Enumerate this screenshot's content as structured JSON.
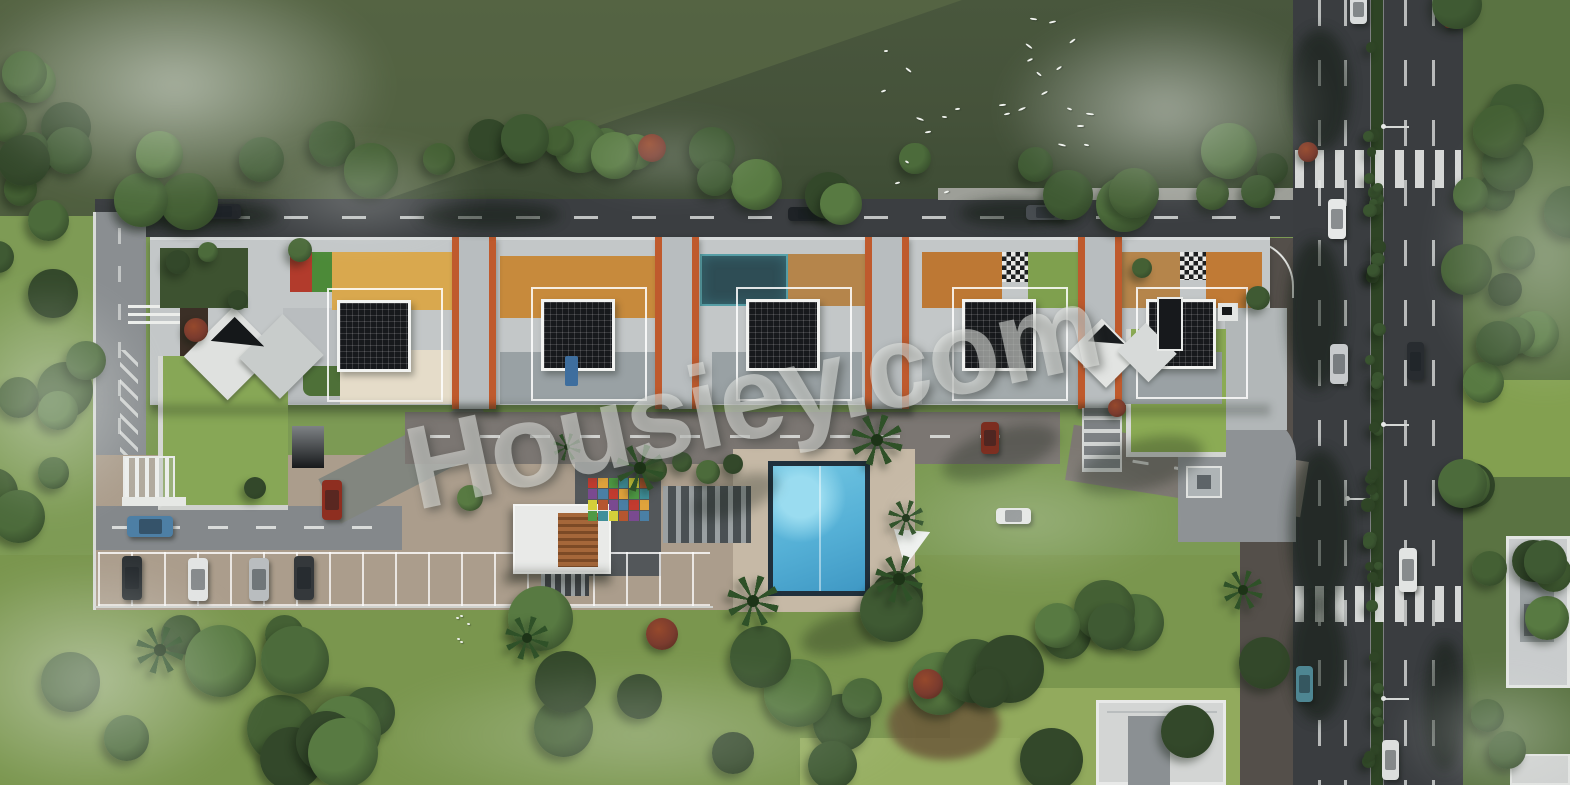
{
  "watermark": {
    "text": "Housiey.com",
    "color": "rgba(230,231,228,0.55)",
    "rotation_deg": -12
  },
  "palette": {
    "field_green": "#45523a",
    "lawn_green": "#87a756",
    "tree_green": "#3f5a33",
    "asphalt": "#3b3e41",
    "internal_road": "#7b7672",
    "paving_tan": "#ab9d8c",
    "slab_gray": "#c3c7c8",
    "accent_terracotta": "#bf5a2d",
    "solar_black": "#17191c",
    "pool_blue": "#55b0d6",
    "deck_orange": "#d9a84e",
    "wood_deck": "#b5854b",
    "court_teal": "#2e4d55",
    "median_green": "#2e4425",
    "fog_white": "#ecf0eb"
  },
  "scene": {
    "solar_panels": [
      {
        "x": 337,
        "y": 300,
        "w": 74,
        "h": 72
      },
      {
        "x": 541,
        "y": 299,
        "w": 74,
        "h": 72
      },
      {
        "x": 746,
        "y": 299,
        "w": 74,
        "h": 72
      },
      {
        "x": 962,
        "y": 299,
        "w": 74,
        "h": 72
      },
      {
        "x": 1146,
        "y": 299,
        "w": 70,
        "h": 70
      }
    ],
    "tower_cores": {
      "xs": [
        452,
        655,
        865,
        1078
      ],
      "y": 237,
      "w": 44,
      "h": 172
    },
    "amenity_segments": [
      {
        "x": 160,
        "y": 248,
        "w": 88,
        "h": 60,
        "color": "#3d5230",
        "pattern": "vstripes"
      },
      {
        "x": 290,
        "y": 252,
        "w": 22,
        "h": 40,
        "color": "#b23b2c"
      },
      {
        "x": 312,
        "y": 252,
        "w": 20,
        "h": 40,
        "color": "#4c8a38"
      },
      {
        "x": 332,
        "y": 252,
        "w": 120,
        "h": 58,
        "color": "#d9a84e",
        "pattern": "hstripes"
      },
      {
        "x": 500,
        "y": 256,
        "w": 155,
        "h": 62,
        "color": "#c78a3c",
        "pattern": "hstripes"
      },
      {
        "x": 700,
        "y": 254,
        "w": 88,
        "h": 52,
        "color": "#2e4d55",
        "pattern": "court"
      },
      {
        "x": 788,
        "y": 254,
        "w": 77,
        "h": 52,
        "color": "#b5854b",
        "pattern": "hstripes"
      },
      {
        "x": 922,
        "y": 252,
        "w": 80,
        "h": 56,
        "color": "#bd7834",
        "pattern": "dots"
      },
      {
        "x": 1002,
        "y": 252,
        "w": 26,
        "h": 30,
        "pattern": "checker"
      },
      {
        "x": 1028,
        "y": 252,
        "w": 52,
        "h": 56,
        "color": "#7fa04e"
      },
      {
        "x": 1122,
        "y": 252,
        "w": 58,
        "h": 56,
        "color": "#b5854b",
        "pattern": "hstripes"
      },
      {
        "x": 1180,
        "y": 252,
        "w": 26,
        "h": 28,
        "pattern": "checker"
      },
      {
        "x": 1206,
        "y": 252,
        "w": 56,
        "h": 56,
        "color": "#c07a35",
        "pattern": "dots"
      }
    ],
    "terraces": [
      {
        "x": 340,
        "y": 350,
        "w": 112,
        "h": 54,
        "color": "#e5dcc9",
        "pattern": "dots-orange"
      },
      {
        "x": 500,
        "y": 352,
        "w": 155,
        "h": 52,
        "color": "#99a1a4",
        "pattern": "dots"
      },
      {
        "x": 712,
        "y": 352,
        "w": 150,
        "h": 52,
        "color": "#99a1a4",
        "pattern": "dots"
      },
      {
        "x": 922,
        "y": 352,
        "w": 156,
        "h": 52,
        "color": "#a3aaac",
        "pattern": "dots"
      },
      {
        "x": 1122,
        "y": 352,
        "w": 100,
        "h": 52,
        "color": "#9aa1a4"
      }
    ],
    "mats": [
      {
        "x": 565,
        "y": 356,
        "w": 13,
        "h": 30,
        "color": "#3e6e9e"
      },
      {
        "x": 837,
        "y": 506,
        "w": 11,
        "h": 22,
        "color": "#27415f"
      },
      {
        "x": 837,
        "y": 540,
        "w": 11,
        "h": 22,
        "color": "#27415f"
      }
    ],
    "playground": {
      "x": 588,
      "y": 478,
      "w": 62,
      "h": 44,
      "cols": 6,
      "rows": 4,
      "colors": [
        "#c23b2f",
        "#e0a33c",
        "#4f9a44",
        "#3f8f9a",
        "#d4cf3a",
        "#b5562f",
        "#7a4a90",
        "#4a7fa5"
      ]
    },
    "cars": [
      {
        "x": 203,
        "y": 204,
        "w": 38,
        "h": 15,
        "color": "#22262a",
        "dir": "h",
        "label": "car-dark"
      },
      {
        "x": 788,
        "y": 207,
        "w": 38,
        "h": 14,
        "color": "#1e2226",
        "dir": "h",
        "label": "car-dark"
      },
      {
        "x": 1026,
        "y": 205,
        "w": 38,
        "h": 15,
        "color": "#474c50",
        "dir": "h",
        "label": "car-gray"
      },
      {
        "x": 1350,
        "y": -6,
        "w": 17,
        "h": 30,
        "color": "#d9dcdc",
        "dir": "v",
        "label": "car-white"
      },
      {
        "x": 1444,
        "y": -4,
        "w": 16,
        "h": 32,
        "color": "#8e3124",
        "dir": "v",
        "label": "truck-red"
      },
      {
        "x": 1328,
        "y": 199,
        "w": 18,
        "h": 40,
        "color": "#e6e8e7",
        "dir": "v",
        "label": "car-white"
      },
      {
        "x": 1330,
        "y": 344,
        "w": 18,
        "h": 40,
        "color": "#c7cacc",
        "dir": "v",
        "label": "car-silver"
      },
      {
        "x": 1407,
        "y": 342,
        "w": 17,
        "h": 38,
        "color": "#282c30",
        "dir": "v",
        "label": "car-dark"
      },
      {
        "x": 1399,
        "y": 548,
        "w": 18,
        "h": 44,
        "color": "#e2e4e3",
        "dir": "v",
        "label": "van-white"
      },
      {
        "x": 1296,
        "y": 666,
        "w": 17,
        "h": 36,
        "color": "#4e8692",
        "dir": "v",
        "label": "car-teal"
      },
      {
        "x": 1382,
        "y": 740,
        "w": 17,
        "h": 40,
        "color": "#dcdedd",
        "dir": "v",
        "label": "car-white"
      },
      {
        "x": 127,
        "y": 516,
        "w": 46,
        "h": 21,
        "color": "#4d7fa5",
        "dir": "h",
        "label": "car-blue"
      },
      {
        "x": 322,
        "y": 480,
        "w": 20,
        "h": 40,
        "color": "#8e2e20",
        "dir": "v",
        "label": "car-red"
      },
      {
        "x": 981,
        "y": 422,
        "w": 18,
        "h": 32,
        "color": "#7c2d1f",
        "dir": "v",
        "label": "car-maroon"
      },
      {
        "x": 996,
        "y": 508,
        "w": 35,
        "h": 16,
        "color": "#e4e6e5",
        "dir": "h",
        "label": "car-white"
      },
      {
        "x": 122,
        "y": 556,
        "w": 20,
        "h": 44,
        "color": "#2c3134",
        "dir": "v",
        "label": "car-dark"
      },
      {
        "x": 188,
        "y": 558,
        "w": 20,
        "h": 43,
        "color": "#e2e4e3",
        "dir": "v",
        "label": "car-white"
      },
      {
        "x": 249,
        "y": 558,
        "w": 20,
        "h": 43,
        "color": "#b9bdbf",
        "dir": "v",
        "label": "car-silver"
      },
      {
        "x": 294,
        "y": 556,
        "w": 20,
        "h": 44,
        "color": "#34383b",
        "dir": "v",
        "label": "car-dark"
      }
    ],
    "palms": [
      {
        "x": 640,
        "y": 468,
        "r": 24
      },
      {
        "x": 877,
        "y": 440,
        "r": 26
      },
      {
        "x": 899,
        "y": 579,
        "r": 24
      },
      {
        "x": 753,
        "y": 601,
        "r": 26
      },
      {
        "x": 906,
        "y": 518,
        "r": 18
      },
      {
        "x": 527,
        "y": 638,
        "r": 22
      },
      {
        "x": 160,
        "y": 650,
        "r": 24
      },
      {
        "x": 1243,
        "y": 590,
        "r": 20
      },
      {
        "x": 567,
        "y": 447,
        "r": 14
      }
    ],
    "palm_shadows": [
      {
        "x": 940,
        "y": 430,
        "w": 120,
        "h": 46,
        "rot": -18
      },
      {
        "x": 1075,
        "y": 440,
        "w": 130,
        "h": 50,
        "rot": -15
      },
      {
        "x": 690,
        "y": 478,
        "w": 90,
        "h": 36,
        "rot": -20
      },
      {
        "x": 800,
        "y": 612,
        "w": 100,
        "h": 40,
        "rot": -15
      },
      {
        "x": 250,
        "y": 690,
        "w": 120,
        "h": 44,
        "rot": -12
      }
    ],
    "road_shadows": [
      {
        "x": 120,
        "y": 200,
        "w": 160,
        "h": 30
      },
      {
        "x": 420,
        "y": 202,
        "w": 140,
        "h": 26
      },
      {
        "x": 960,
        "y": 200,
        "w": 120,
        "h": 26
      },
      {
        "x": 1290,
        "y": 30,
        "w": 60,
        "h": 120
      },
      {
        "x": 1288,
        "y": 240,
        "w": 55,
        "h": 150
      },
      {
        "x": 1290,
        "y": 450,
        "w": 60,
        "h": 160
      },
      {
        "x": 1290,
        "y": 600,
        "w": 55,
        "h": 120
      },
      {
        "x": 1425,
        "y": 640,
        "w": 40,
        "h": 130
      }
    ],
    "fog": [
      {
        "x": -40,
        "y": -30,
        "w": 430,
        "h": 230,
        "o": 0.6
      },
      {
        "x": 240,
        "y": 140,
        "w": 240,
        "h": 110,
        "o": 0.3
      },
      {
        "x": 1000,
        "y": 10,
        "w": 330,
        "h": 200,
        "o": 0.55
      },
      {
        "x": 1430,
        "y": 110,
        "w": 230,
        "h": 290,
        "o": 0.4
      },
      {
        "x": -60,
        "y": 280,
        "w": 220,
        "h": 240,
        "o": 0.45
      },
      {
        "x": -80,
        "y": 560,
        "w": 340,
        "h": 240,
        "o": 0.5
      },
      {
        "x": 360,
        "y": 660,
        "w": 560,
        "h": 150,
        "o": 0.3
      },
      {
        "x": 880,
        "y": 455,
        "w": 300,
        "h": 130,
        "o": 0.26
      },
      {
        "x": 1390,
        "y": 665,
        "w": 220,
        "h": 135,
        "o": 0.35
      },
      {
        "x": 560,
        "y": 115,
        "w": 220,
        "h": 85,
        "o": 0.25
      }
    ],
    "tree_bands": [
      {
        "x0": 10,
        "x1": 1285,
        "y0": 138,
        "y1": 205,
        "count": 30,
        "rmin": 14,
        "rmax": 30
      },
      {
        "x0": -15,
        "x1": 70,
        "y0": 30,
        "y1": 200,
        "count": 8,
        "rmin": 14,
        "rmax": 26
      },
      {
        "x0": -10,
        "x1": 92,
        "y0": 210,
        "y1": 545,
        "count": 10,
        "rmin": 15,
        "rmax": 28
      },
      {
        "x0": -10,
        "x1": 1290,
        "y0": 595,
        "y1": 765,
        "count": 36,
        "rmin": 18,
        "rmax": 36
      },
      {
        "x0": 1452,
        "x1": 1570,
        "y0": -10,
        "y1": 385,
        "count": 14,
        "rmin": 15,
        "rmax": 28
      },
      {
        "x0": 1455,
        "x1": 1570,
        "y0": 470,
        "y1": 780,
        "count": 10,
        "rmin": 14,
        "rmax": 26
      }
    ],
    "median_bushes": {
      "x0": 1368,
      "x1": 1380,
      "y0": 5,
      "y1": 780,
      "count": 44,
      "rmin": 4,
      "rmax": 7
    },
    "extra_trees": [
      {
        "x": 178,
        "y": 262,
        "r": 12
      },
      {
        "x": 208,
        "y": 252,
        "r": 10
      },
      {
        "x": 300,
        "y": 250,
        "r": 12
      },
      {
        "x": 238,
        "y": 300,
        "r": 10
      },
      {
        "x": 1142,
        "y": 268,
        "r": 10
      },
      {
        "x": 1258,
        "y": 298,
        "r": 12
      },
      {
        "x": 655,
        "y": 470,
        "r": 12
      },
      {
        "x": 682,
        "y": 462,
        "r": 10
      },
      {
        "x": 708,
        "y": 472,
        "r": 12
      },
      {
        "x": 733,
        "y": 464,
        "r": 10
      },
      {
        "x": 255,
        "y": 488,
        "r": 11
      },
      {
        "x": 470,
        "y": 498,
        "r": 13
      }
    ],
    "red_trees": [
      {
        "x": 652,
        "y": 148,
        "r": 14
      },
      {
        "x": 1308,
        "y": 152,
        "r": 10
      },
      {
        "x": 196,
        "y": 330,
        "r": 12
      },
      {
        "x": 662,
        "y": 634,
        "r": 16
      },
      {
        "x": 928,
        "y": 684,
        "r": 15
      },
      {
        "x": 1117,
        "y": 408,
        "r": 9
      }
    ],
    "birds": {
      "count": 26,
      "box": {
        "x": 868,
        "y": 14,
        "w": 225,
        "h": 185
      },
      "ground": {
        "x": 432,
        "y": 606,
        "w": 36,
        "h": 42,
        "count": 5
      }
    },
    "streetlights": [
      {
        "x": 1383,
        "y": 126
      },
      {
        "x": 1383,
        "y": 424
      },
      {
        "x": 1347,
        "y": 498
      },
      {
        "x": 1383,
        "y": 698
      }
    ],
    "crosswalks": [
      {
        "y": 150,
        "h": 38
      },
      {
        "y": 586,
        "h": 36
      }
    ],
    "lane_dashes_x": [
      1318,
      1344,
      1404,
      1432
    ]
  }
}
